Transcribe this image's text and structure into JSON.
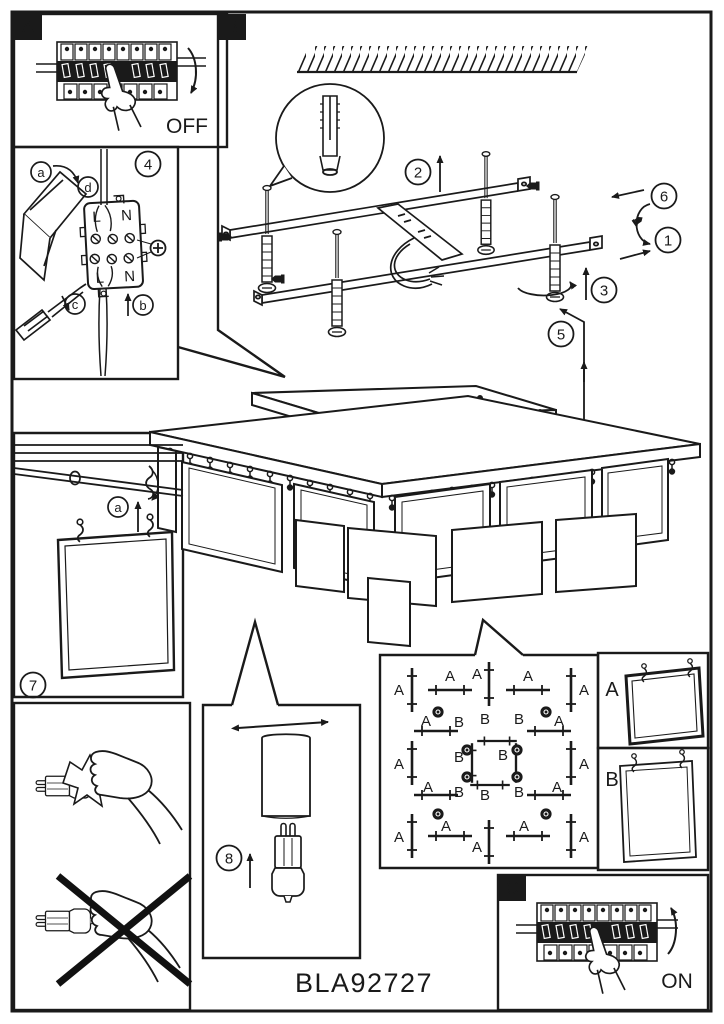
{
  "model_number": "BLA92727",
  "panel_a": {
    "tag": "A",
    "state_label": "OFF"
  },
  "panel_c": {
    "tag": "C",
    "state_label": "ON"
  },
  "panel_b": {
    "tag": "B",
    "step_1": "1",
    "step_2": "2",
    "step_3": "3",
    "step_5": "5",
    "step_6": "6"
  },
  "panel_wiring": {
    "step_4": "4",
    "letter_a": "a",
    "letter_b": "b",
    "letter_c": "c",
    "letter_d": "d",
    "terminal_l_top": "L",
    "terminal_n_top": "N",
    "terminal_l_bottom": "L",
    "terminal_n_bottom": "N"
  },
  "panel_hang": {
    "step_7": "7",
    "letter_a": "a"
  },
  "panel_bulb": {
    "step_8": "8"
  },
  "panel_plan": {
    "outer_labels": [
      "A",
      "A",
      "A",
      "A",
      "A",
      "A",
      "A",
      "A",
      "A",
      "A",
      "A",
      "A",
      "A",
      "A",
      "A",
      "A"
    ],
    "inner_labels": [
      "B",
      "B",
      "B",
      "B",
      "B",
      "B",
      "B",
      "B"
    ]
  },
  "panel_shade_a": {
    "tag": "A"
  },
  "panel_shade_b": {
    "tag": "B"
  }
}
